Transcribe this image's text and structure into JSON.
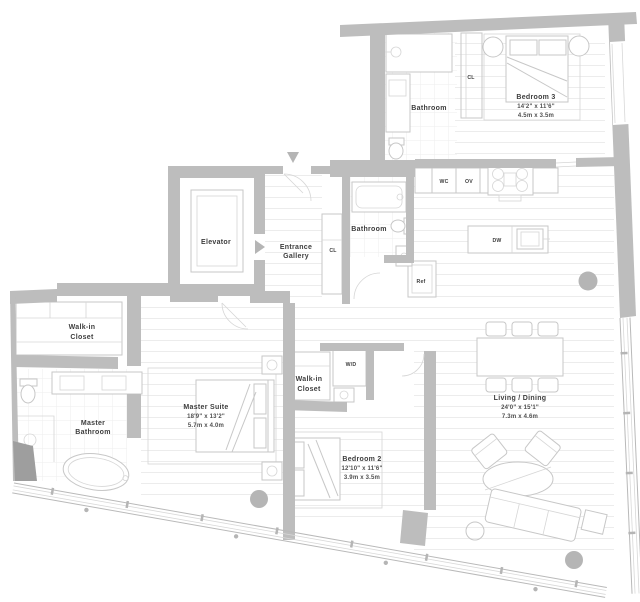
{
  "colors": {
    "wall": "#bdbdbd",
    "wall_dark": "#9e9e9e",
    "furniture_line": "#c7c7c7",
    "floor_line": "#ececec",
    "glass_line": "#b9b9b9",
    "text": "#3d3d3d"
  },
  "rooms": {
    "bathroom_top": {
      "name": "Bathroom"
    },
    "bedroom3": {
      "name": "Bedroom 3",
      "dim_ft": "14'2\" x 11'6\"",
      "dim_m": "4.5m x 3.5m"
    },
    "elevator": {
      "name": "Elevator"
    },
    "entrance_gallery": {
      "line1": "Entrance",
      "line2": "Gallery"
    },
    "bathroom_mid": {
      "name": "Bathroom"
    },
    "walk_in_closet_1": {
      "line1": "Walk-in",
      "line2": "Closet"
    },
    "master_bathroom": {
      "line1": "Master",
      "line2": "Bathroom"
    },
    "master_suite": {
      "name": "Master Suite",
      "dim_ft": "18'9\" x 13'2\"",
      "dim_m": "5.7m x 4.0m"
    },
    "walk_in_closet_2": {
      "line1": "Walk-in",
      "line2": "Closet"
    },
    "bedroom2": {
      "name": "Bedroom 2",
      "dim_ft": "12'10\" x 11'6\"",
      "dim_m": "3.9m x 3.5m"
    },
    "living_dining": {
      "name": "Living / Dining",
      "dim_ft": "24'0\" x 15'1\"",
      "dim_m": "7.3m x 4.6m"
    }
  },
  "labels": {
    "cl_top": "CL",
    "cl_hall": "CL",
    "wc": "WC",
    "ov": "OV",
    "dw": "DW",
    "ref": "Ref",
    "wd": "W/D"
  }
}
